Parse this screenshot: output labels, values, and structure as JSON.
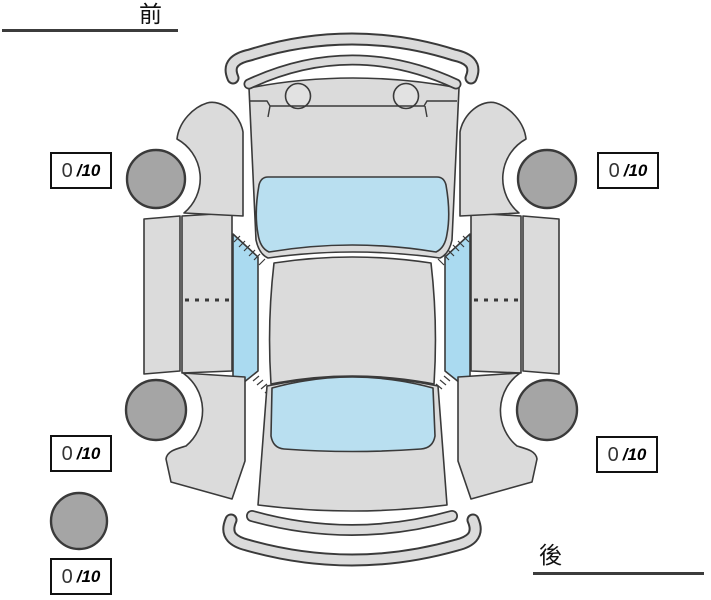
{
  "labels": {
    "front": "前",
    "rear": "後"
  },
  "scores": {
    "front_left": {
      "value": "0",
      "max": "/10"
    },
    "front_right": {
      "value": "0",
      "max": "/10"
    },
    "rear_left": {
      "value": "0",
      "max": "/10"
    },
    "rear_right": {
      "value": "0",
      "max": "/10"
    },
    "overall": {
      "value": "0",
      "max": "/10"
    }
  },
  "colors": {
    "body": "#dbdbdb",
    "glass": "#b9dff0",
    "glass-side": "#aadaf0",
    "wheel": "#a5a5a5",
    "light": "#e2e2e2",
    "line": "#3a3a3a",
    "label": "#111111"
  }
}
